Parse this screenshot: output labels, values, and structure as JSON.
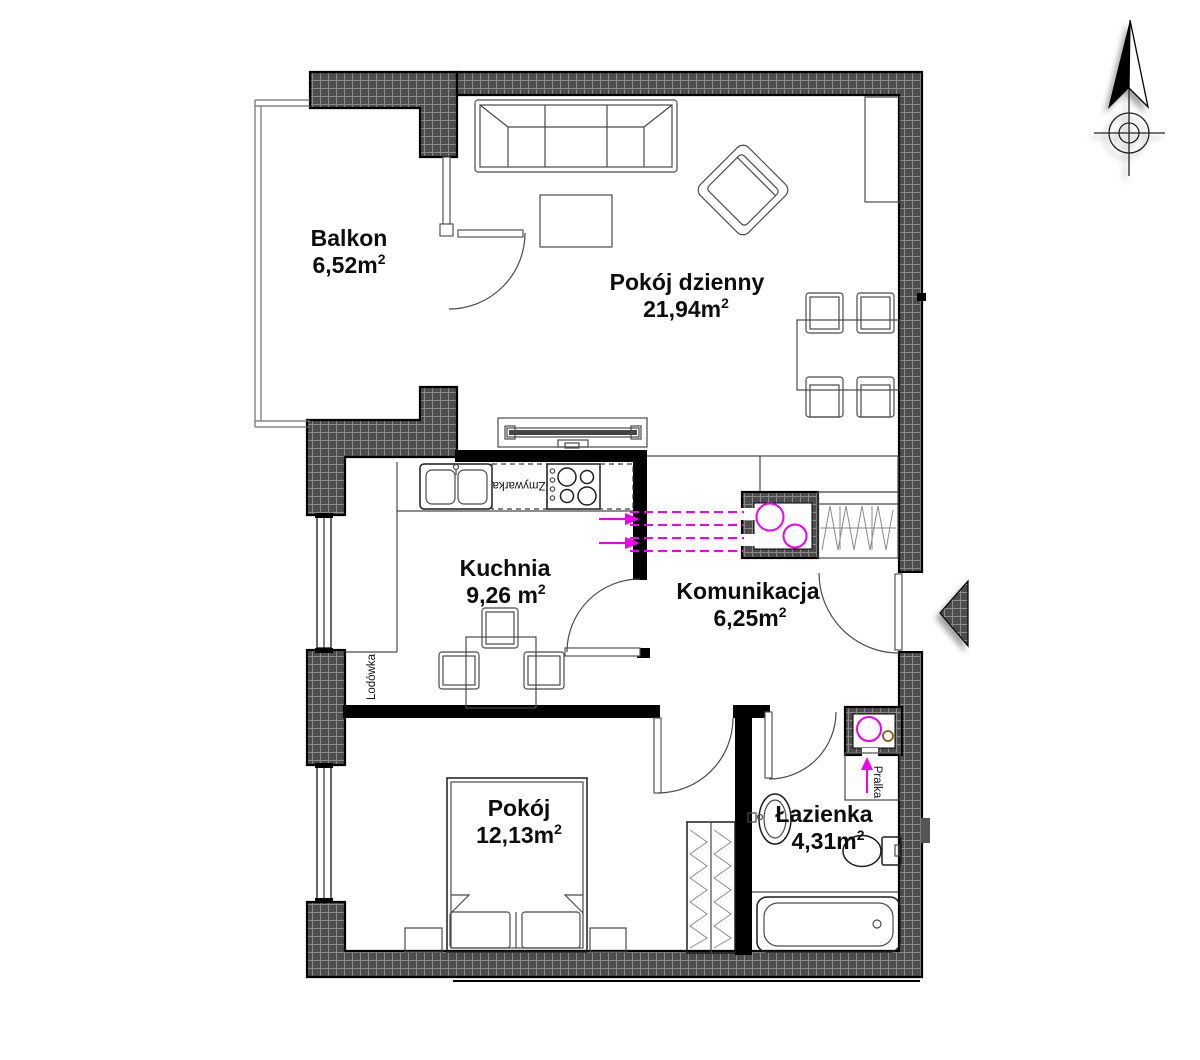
{
  "plan": {
    "rooms": [
      {
        "name": "Balkon",
        "area": "6,52m",
        "area_sup": "2"
      },
      {
        "name": "Pokój dzienny",
        "area": "21,94m",
        "area_sup": "2"
      },
      {
        "name": "Kuchnia",
        "area": "9,26 m",
        "area_sup": "2"
      },
      {
        "name": "Komunikacja",
        "area": "6,25m",
        "area_sup": "2"
      },
      {
        "name": "Pokój",
        "area": "12,13m",
        "area_sup": "2"
      },
      {
        "name": "Łazienka",
        "area": "4,31m",
        "area_sup": "2"
      }
    ],
    "labels": {
      "dishwasher": "Zmywarka",
      "fridge": "Lodówka",
      "washer": "Pralka"
    },
    "icons": {
      "compass": "north-arrow",
      "entrance": "entrance-triangle-marker",
      "ventilation": "magenta-duct-circles"
    },
    "colors": {
      "wall_fill": "#4d4d4d",
      "wall_grid": "#8a8a8a",
      "accent_magenta": "#ee00ee",
      "detail_brown": "#8a6a22",
      "line": "#000000",
      "background": "#ffffff"
    }
  }
}
